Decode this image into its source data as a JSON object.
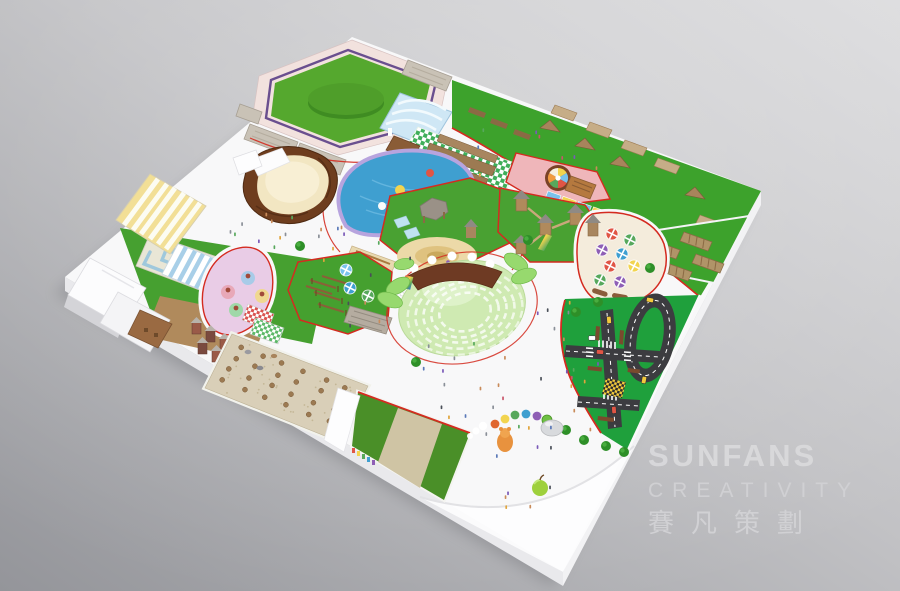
{
  "watermark": {
    "brand": "SUNFANS",
    "subtitle": "CREATIVITY",
    "cjk": "賽凡策劃"
  },
  "palette": {
    "background_top": "#d9d9db",
    "background_bottom": "#94959a",
    "board": "#f8f8f9",
    "board_side": "#ededf0",
    "path_red": "#d42b20",
    "lawn": "#3da22c",
    "lawn_bright": "#55a82e",
    "left_lawn": "#46a030",
    "rope_lawn": "#45a02f",
    "field_green": "#4a8f28",
    "traffic_lawn": "#1fa03c",
    "road": "#3c3c40",
    "pool_water": "#3f9fd0",
    "pool_rim": "#b7a4de",
    "sand": "#f2e6c2",
    "sand_bowl_rim": "#6e3d1e",
    "gravel": "#d9cfb8",
    "wood": "#a07848",
    "wood_dark": "#8a5c3a",
    "roof_gray": "#938c84",
    "pink_zone": "#efb6ba",
    "lavender_zone": "#e9cce6",
    "amphitheater": "#cfeab2",
    "leaf_green": "#97d96e",
    "canopy_yellow": "#f2df96",
    "awning_blue": "#a8cfe8",
    "checker_green": "#3fae5a",
    "checker_blue": "#79c2ec",
    "checker_yellow": "#f2d44f"
  },
  "zones": [
    {
      "name": "lawn-stage-plaza",
      "color": "#55a82e"
    },
    {
      "name": "entrance-arch-canopy",
      "color": "#cfe7f5"
    },
    {
      "name": "obstacle-course-lawn",
      "color": "#3da22c"
    },
    {
      "name": "checkered-dining-strip",
      "color": "#3fae5a"
    },
    {
      "name": "color-wheel-plaza",
      "color": "#efb6ba"
    },
    {
      "name": "log-cabin",
      "color": "#b5793f"
    },
    {
      "name": "awning-market-rows",
      "color": "#79c2ec"
    },
    {
      "name": "swimming-pool",
      "color": "#3f9fd0"
    },
    {
      "name": "pool-kiosk",
      "color": "#e8d9b0"
    },
    {
      "name": "sand-play-zone",
      "color": "#f2e6c2"
    },
    {
      "name": "adventure-towers",
      "color": "#a8865f"
    },
    {
      "name": "umbrella-dining-garden",
      "color": "#f4ecdc"
    },
    {
      "name": "rainbow-tunnel",
      "color": "#e05545"
    },
    {
      "name": "amphitheater",
      "color": "#cfeab2"
    },
    {
      "name": "rope-course",
      "color": "#45a02f"
    },
    {
      "name": "picnic-bbq-garden",
      "color": "#e9cce6"
    },
    {
      "name": "maze",
      "color": "#9fc8dc"
    },
    {
      "name": "giant-sand-bowl",
      "color": "#6e3d1e"
    },
    {
      "name": "striped-canopy-pavilion",
      "color": "#f2df96"
    },
    {
      "name": "entrance-halls",
      "color": "#fcfcfd"
    },
    {
      "name": "mini-castle-village",
      "color": "#9a5a48"
    },
    {
      "name": "gravel-dining-court",
      "color": "#d9cfb8"
    },
    {
      "name": "farm-field",
      "color": "#4a8f28"
    },
    {
      "name": "traffic-town",
      "color": "#1fa03c"
    },
    {
      "name": "pergola-gardens",
      "color": "#b09468"
    },
    {
      "name": "kiddie-train",
      "color": "#e0662e"
    },
    {
      "name": "apple-sculpture",
      "color": "#9ed03c"
    }
  ],
  "decor": {
    "people_colors": [
      "#c9566a",
      "#5a79b8",
      "#57a85c",
      "#e0a43c",
      "#8a8f98",
      "#c98b5a",
      "#7a5ab8",
      "#4a4f58"
    ],
    "umbrella_colors": [
      "#e05545",
      "#57a85c",
      "#8e5fb5",
      "#3f9fd0",
      "#f2d44f",
      "#79c2ec"
    ]
  }
}
